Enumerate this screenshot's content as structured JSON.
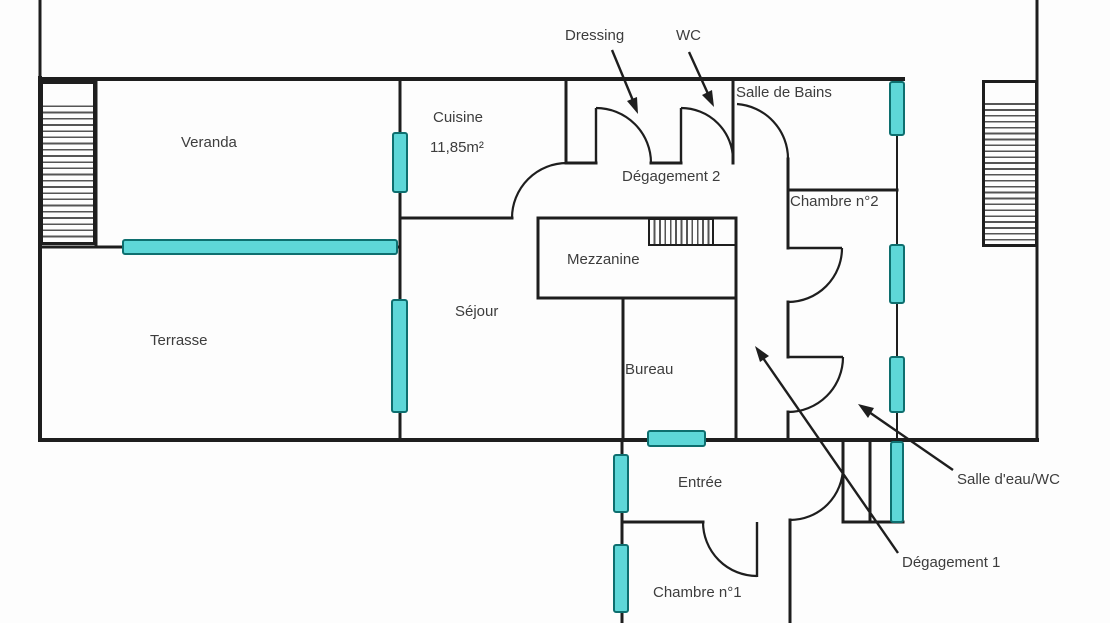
{
  "title": "Plan d'étage",
  "colors": {
    "wall": "#1e1e1e",
    "hatch": "#555555",
    "text": "#3d3d3d",
    "window_fill": "#5ed7d8",
    "window_stroke": "#0e6f6f"
  },
  "rooms": {
    "veranda": {
      "label": "Veranda"
    },
    "terrasse": {
      "label": "Terrasse"
    },
    "cuisine": {
      "label": "Cuisine",
      "area": "11,85m²"
    },
    "sejour": {
      "label": "Séjour"
    },
    "mezzanine": {
      "label": "Mezzanine"
    },
    "bureau": {
      "label": "Bureau"
    },
    "entree": {
      "label": "Entrée"
    },
    "chambre1": {
      "label": "Chambre n°1"
    },
    "chambre2": {
      "label": "Chambre n°2"
    },
    "salle_de_bains": {
      "label": "Salle de Bains"
    },
    "degagement2": {
      "label": "Dégagement 2"
    }
  },
  "callouts": {
    "dressing": {
      "label": "Dressing"
    },
    "wc": {
      "label": "WC"
    },
    "salle_eau_wc": {
      "label": "Salle d'eau/WC"
    },
    "degagement1": {
      "label": "Dégagement 1"
    }
  }
}
